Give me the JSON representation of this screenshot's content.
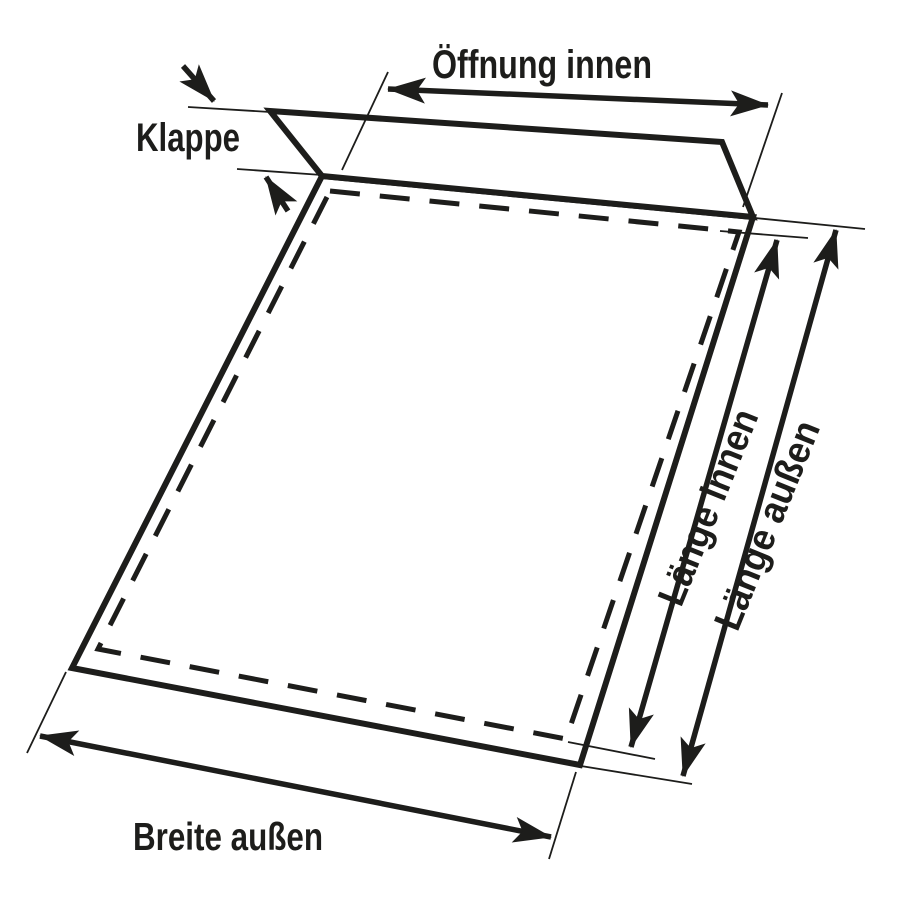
{
  "diagram": {
    "colors": {
      "ink": "#1d1d1b",
      "background": "#ffffff"
    },
    "labels": {
      "opening_inner": "Öffnung innen",
      "flap": "Klappe",
      "length_inner": "Länge innen",
      "length_outer": "Länge außen",
      "width_outer": "Breite außen"
    }
  }
}
